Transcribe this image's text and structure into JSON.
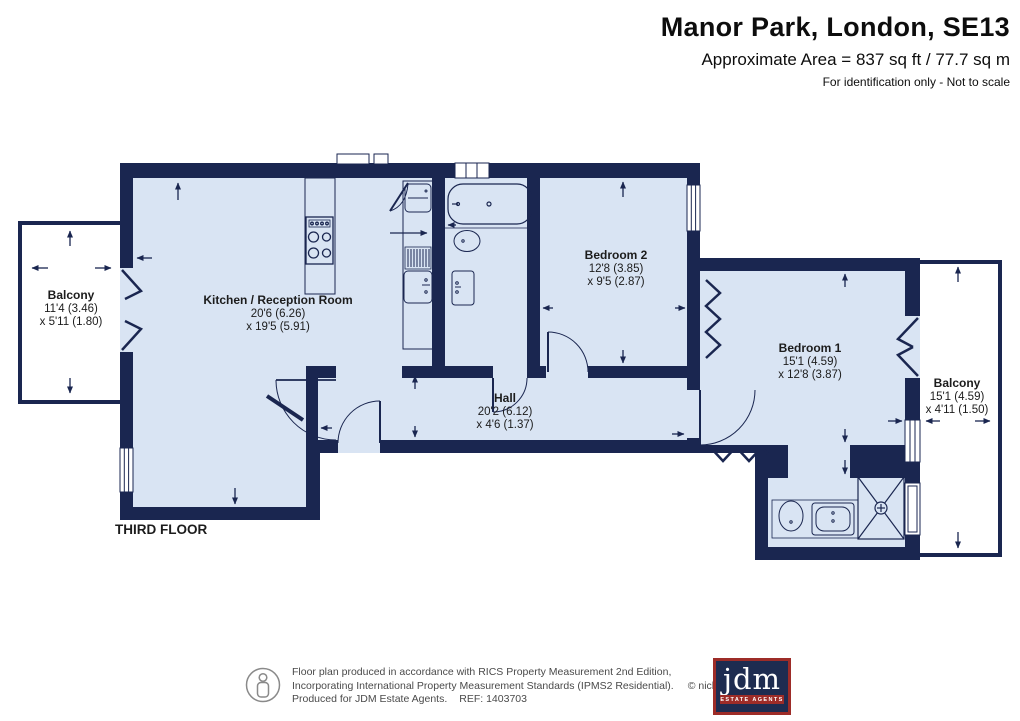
{
  "header": {
    "title": "Manor Park, London, SE13",
    "area_line": "Approximate Area = 837 sq ft / 77.7 sq m",
    "note_line": "For identification only - Not to scale"
  },
  "plan": {
    "floor_label": "THIRD FLOOR",
    "rooms": {
      "kitchen": {
        "name": "Kitchen / Reception Room",
        "dim1": "20'6 (6.26)",
        "dim2": "x 19'5 (5.91)"
      },
      "hall": {
        "name": "Hall",
        "dim1": "20'2 (6.12)",
        "dim2": "x 4'6 (1.37)"
      },
      "bedroom2": {
        "name": "Bedroom 2",
        "dim1": "12'8 (3.85)",
        "dim2": "x 9'5 (2.87)"
      },
      "bedroom1": {
        "name": "Bedroom 1",
        "dim1": "15'1 (4.59)",
        "dim2": "x 12'8 (3.87)"
      },
      "balcony_left": {
        "name": "Balcony",
        "dim1": "11'4 (3.46)",
        "dim2": "x 5'11 (1.80)"
      },
      "balcony_right": {
        "name": "Balcony",
        "dim1": "15'1 (4.59)",
        "dim2": "x 4'11 (1.50)"
      }
    }
  },
  "footer": {
    "line1": "Floor plan produced in accordance with RICS Property Measurement 2nd Edition,",
    "line2": "Incorporating International Property Measurement Standards (IPMS2 Residential).",
    "copyright": "© nichecom 2026.",
    "line3": "Produced for JDM Estate Agents.",
    "ref": "REF: 1403703"
  },
  "logo": {
    "name": "jdm",
    "tagline": "ESTATE AGENTS"
  },
  "colors": {
    "wall": "#1a2650",
    "room_fill": "#d9e4f3",
    "logo_red": "#9d2c28",
    "logo_navy": "#1e2c50"
  }
}
